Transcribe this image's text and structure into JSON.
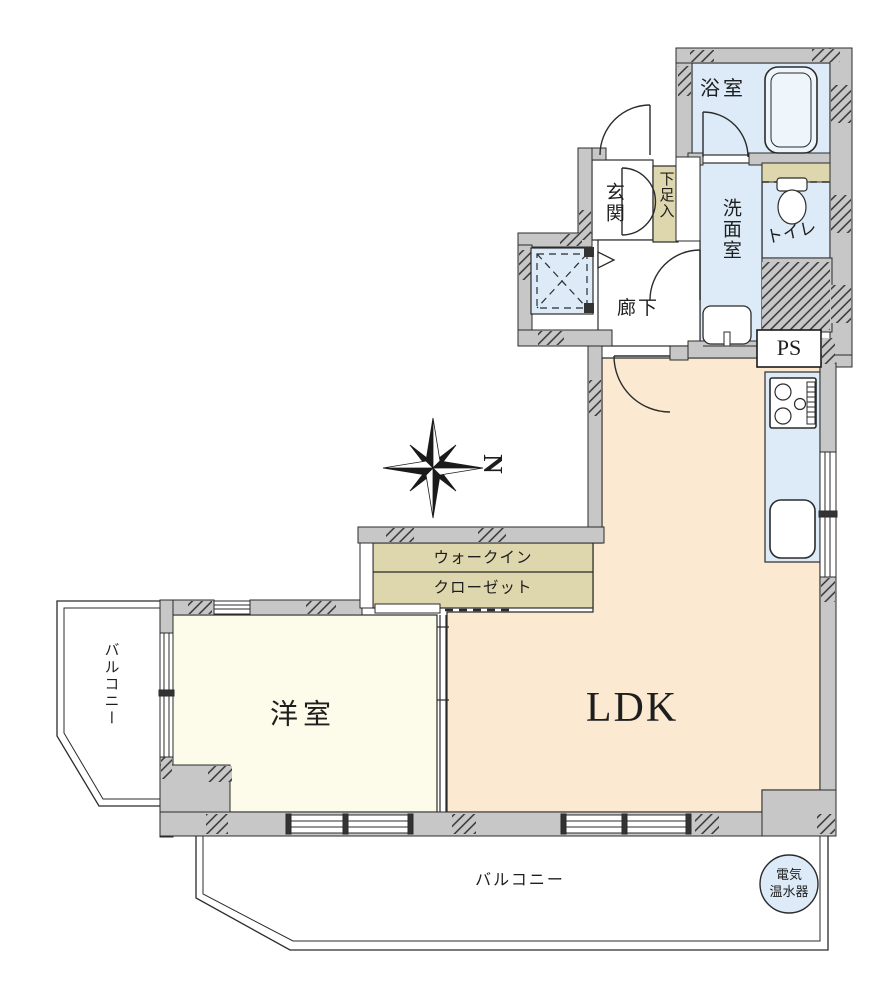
{
  "meta": {
    "type": "japanese-apartment-floor-plan"
  },
  "colors": {
    "wall": "#c7c7c7",
    "water_room": "#dcebf7",
    "western_room": "#fdfbe9",
    "ldk_room": "#fbe9d1",
    "closet_tan": "#ded6ac",
    "line": "#2b2b2b",
    "fixture": "#eef6fc"
  },
  "rooms": {
    "bath": {
      "label": "浴室"
    },
    "toilet": {
      "label": "トイレ"
    },
    "washroom": {
      "label": "洗面室"
    },
    "entrance": {
      "label": "玄関"
    },
    "shoe_cabinet": {
      "label": "下足入"
    },
    "hallway": {
      "label": "廊下"
    },
    "pipe_space": {
      "label": "PS"
    },
    "walk_in_closet": {
      "label_line1": "ウォークイン",
      "label_line2": "クローゼット"
    },
    "western_room": {
      "label": "洋室"
    },
    "ldk": {
      "label": "LDK"
    },
    "balcony_left": {
      "label": "バルコニー"
    },
    "balcony_bottom": {
      "label": "バルコニー"
    },
    "water_heater": {
      "label_line1": "電気",
      "label_line2": "温水器"
    }
  },
  "compass": {
    "north_label": "N"
  }
}
